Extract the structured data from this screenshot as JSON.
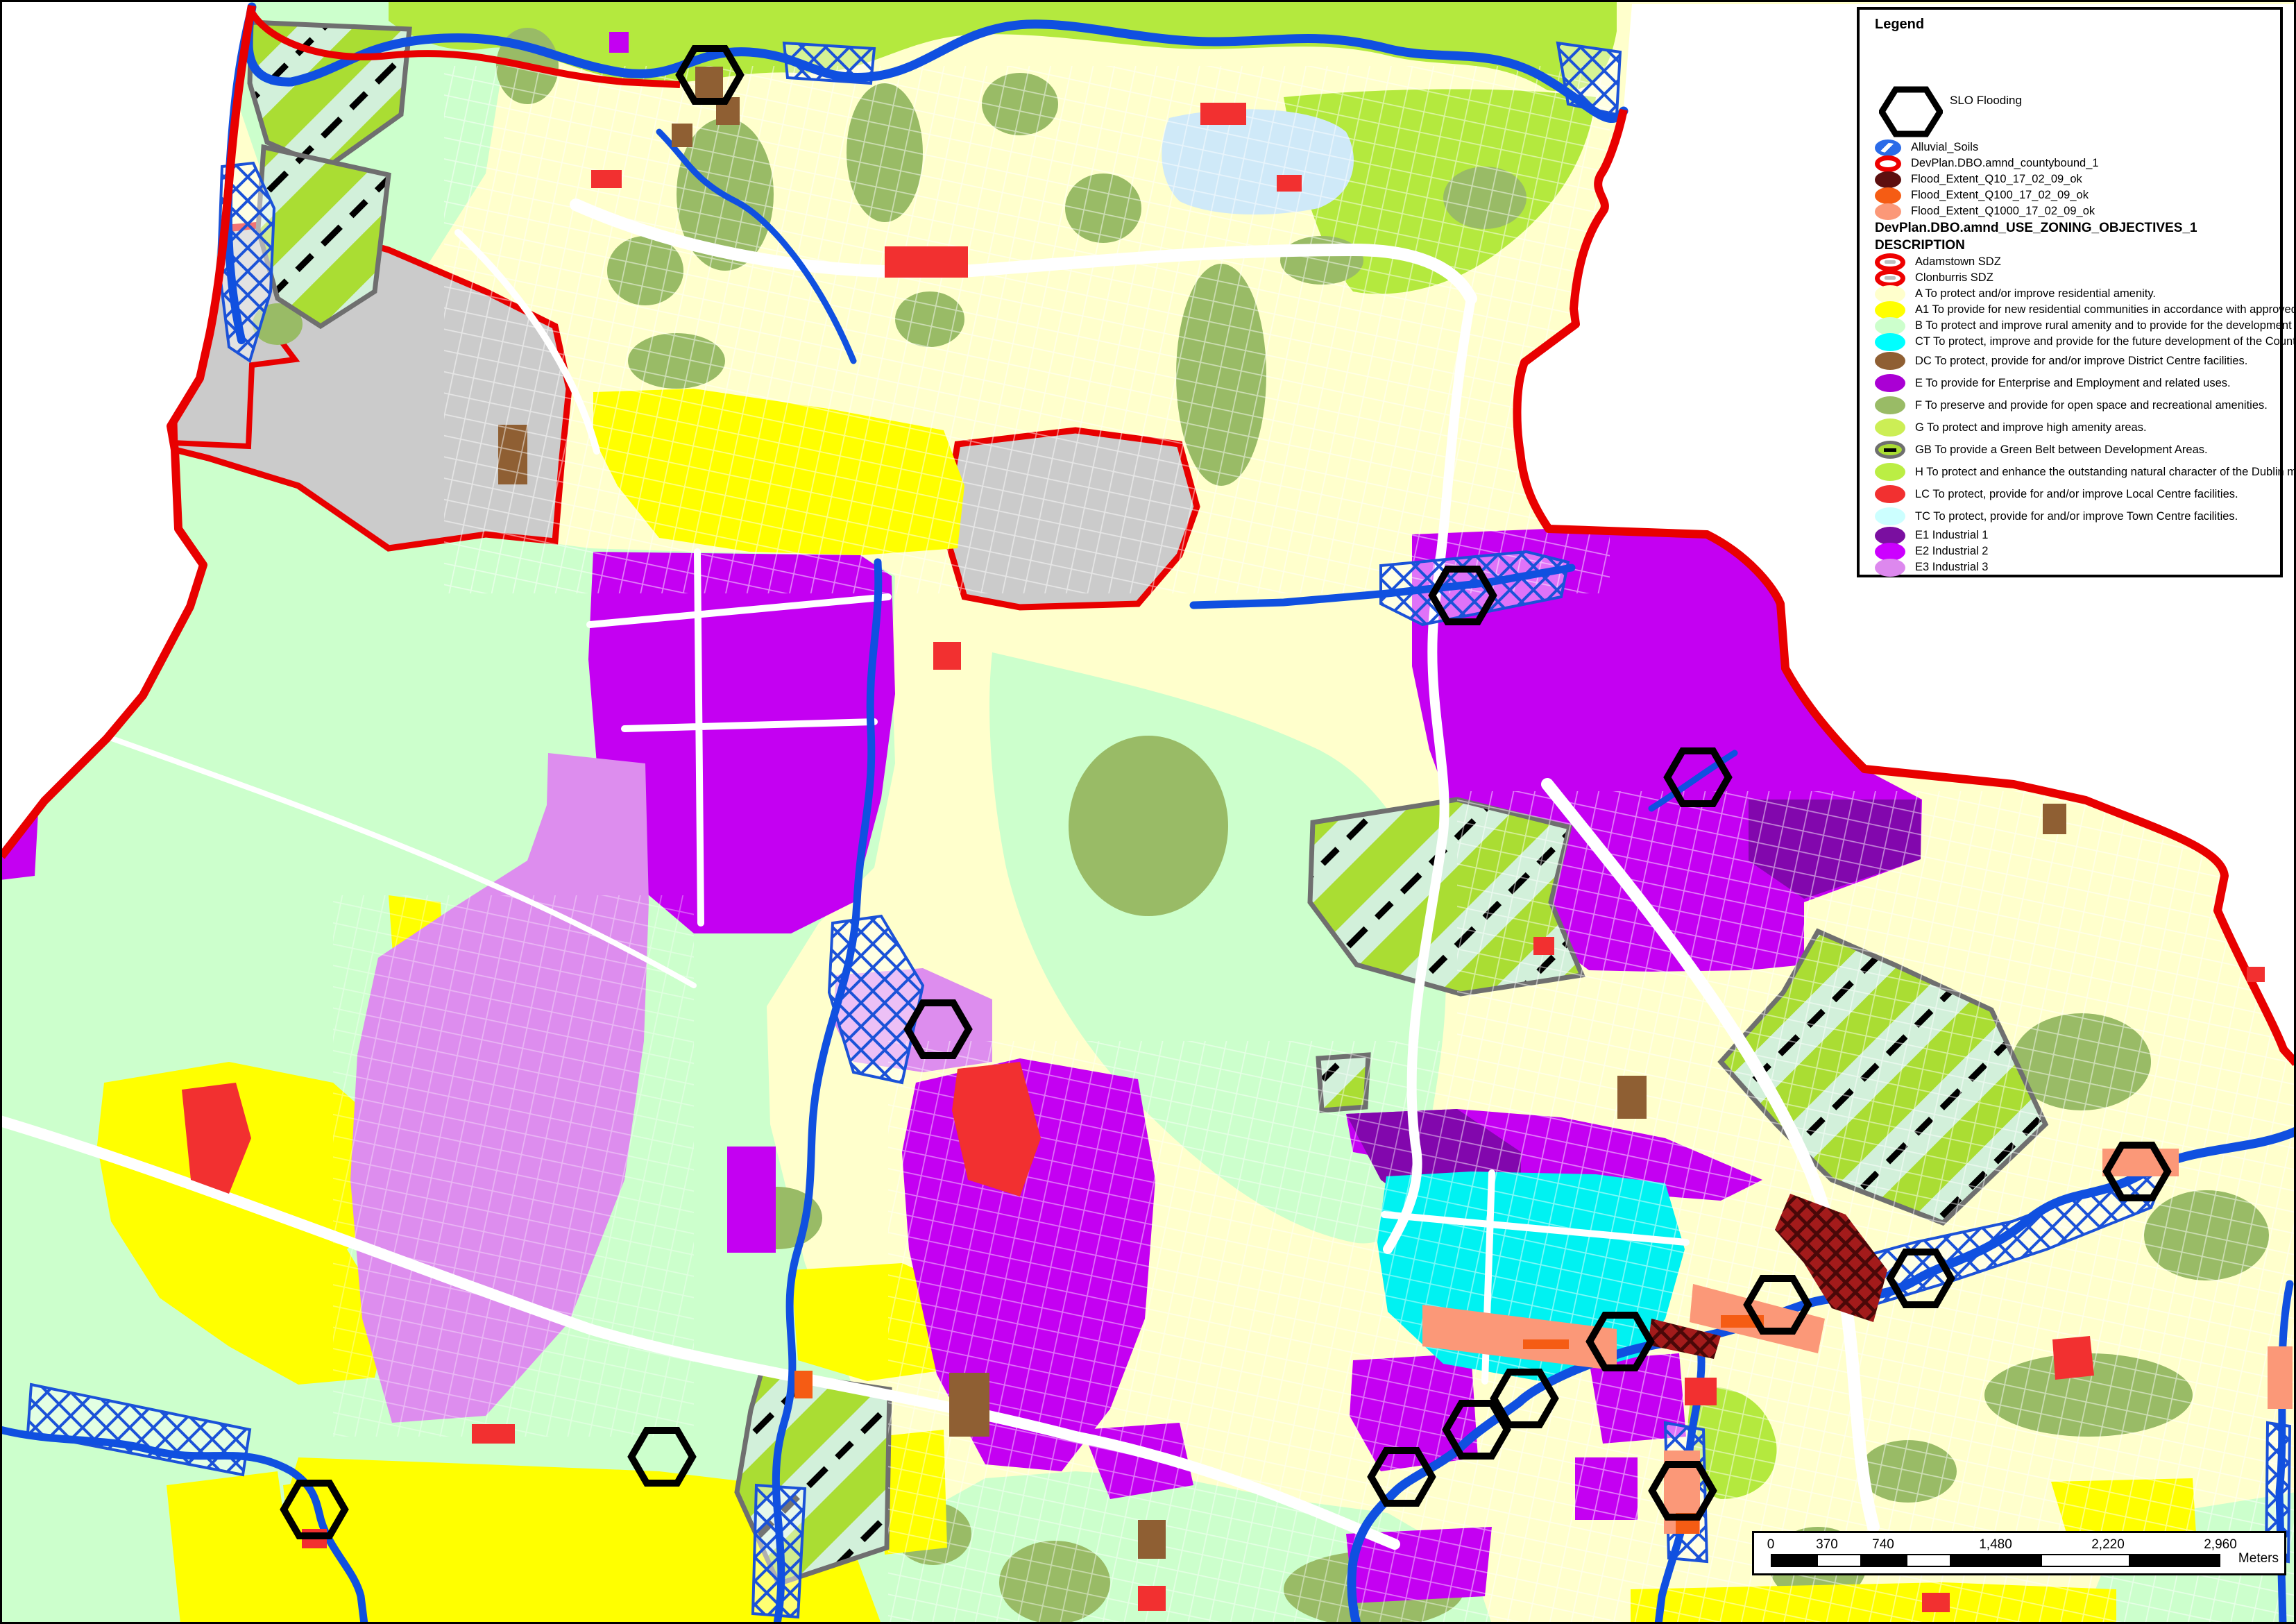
{
  "legend": {
    "title": "Legend",
    "slo_label": "SLO Flooding",
    "overlays": [
      {
        "label": "Alluvial_Soils",
        "color": "#2b6be8",
        "swatch": "blue-crosshatch-ellipse"
      },
      {
        "label": "DevPlan.DBO.amnd_countybound_1",
        "color": "#ee0000",
        "swatch": "red-outline-ellipse"
      },
      {
        "label": "Flood_Extent_Q10_17_02_09_ok",
        "color": "#5c0f0f",
        "swatch": "solid-ellipse"
      },
      {
        "label": "Flood_Extent_Q100_17_02_09_ok",
        "color": "#f55c14",
        "swatch": "solid-ellipse"
      },
      {
        "label": "Flood_Extent_Q1000_17_02_09_ok",
        "color": "#fb9878",
        "swatch": "solid-ellipse"
      }
    ],
    "layer_heading": "DevPlan.DBO.amnd_USE_ZONING_OBJECTIVES_1",
    "description_heading": "DESCRIPTION",
    "zones": [
      {
        "label": "Adamstown SDZ",
        "color": "#ee0000",
        "swatch": "red-outline-ellipse"
      },
      {
        "label": "Clonburris SDZ",
        "color": "#ee0000",
        "swatch": "red-outline-ellipse"
      },
      {
        "label": "A To protect and/or improve residential amenity.",
        "color": "#ffffcc"
      },
      {
        "label": "A1 To provide for new residential communities in accordance with approved Area Plans.",
        "color": "#ffff00"
      },
      {
        "label": "B To protect and improve rural amenity and to provide for the development of agriculture.",
        "color": "#ccffcc"
      },
      {
        "label": "CT To protect, improve and provide for the future development of the County Town of Tallaght",
        "color": "#00ffff"
      },
      {
        "label": "DC To protect, provide for and/or improve District Centre facilities.",
        "color": "#8f5f33"
      },
      {
        "label": "E To provide for Enterprise and Employment and related uses.",
        "color": "#aa00d4"
      },
      {
        "label": "F To preserve and provide for open space and recreational amenities.",
        "color": "#99bb66"
      },
      {
        "label": "G To protect and improve high amenity areas.",
        "color": "#ccee55"
      },
      {
        "label": "GB To provide a Green Belt between Development Areas.",
        "color": "#aadd33"
      },
      {
        "label": "H To protect and enhance the outstanding natural character of the Dublin mountain Area.",
        "color": "#bbee44"
      },
      {
        "label": "LC To protect, provide for and/or improve Local Centre facilities.",
        "color": "#f23030"
      },
      {
        "label": "TC To protect, provide for and/or improve Town Centre facilities.",
        "color": "#ccffff"
      },
      {
        "label": "E1 Industrial 1",
        "color": "#7a0fa0"
      },
      {
        "label": "E2 Industrial 2",
        "color": "#cc00ff"
      },
      {
        "label": "E3 Industrial 3",
        "color": "#dd88ee"
      }
    ]
  },
  "scalebar": {
    "ticks": [
      "0",
      "370",
      "740",
      "1,480",
      "2,220",
      "2,960"
    ],
    "unit": "Meters"
  },
  "map": {
    "colors": {
      "outside_county": "#ffffff",
      "residential_a": "#ffffcc",
      "new_residential_a1": "#ffff00",
      "rural_b": "#ccffcc",
      "tallaght_ct": "#00f2f2",
      "district_centre_dc": "#8f5f33",
      "enterprise_e": "#c400f2",
      "industrial_e1": "#8207ad",
      "industrial_e3": "#dd8dee",
      "open_space_f": "#99bb66",
      "high_amenity_gh": "#b4e93e",
      "greenbelt_stripe": "#aadd33",
      "local_centre_lc": "#f23030",
      "unzoned_sdz_grey": "#cbcbcb",
      "river": "#1050e0",
      "county_boundary": "#e80000",
      "flood_q10": "#5c0f0f",
      "flood_q100": "#f55c14",
      "flood_q1000": "#fb9878",
      "road": "#ffffff",
      "pond": "#cfe9f8"
    },
    "slo_markers": {
      "label": "SLO Flooding",
      "positions": [
        [
          1023,
          108
        ],
        [
          2108,
          858
        ],
        [
          2447,
          1120
        ],
        [
          1352,
          1483
        ],
        [
          3080,
          1688
        ],
        [
          2768,
          1842
        ],
        [
          2562,
          1880
        ],
        [
          2335,
          1933
        ],
        [
          2197,
          2015
        ],
        [
          2128,
          2060
        ],
        [
          2020,
          2128
        ],
        [
          954,
          2099
        ],
        [
          453,
          2175
        ],
        [
          2425,
          2148
        ]
      ]
    }
  }
}
